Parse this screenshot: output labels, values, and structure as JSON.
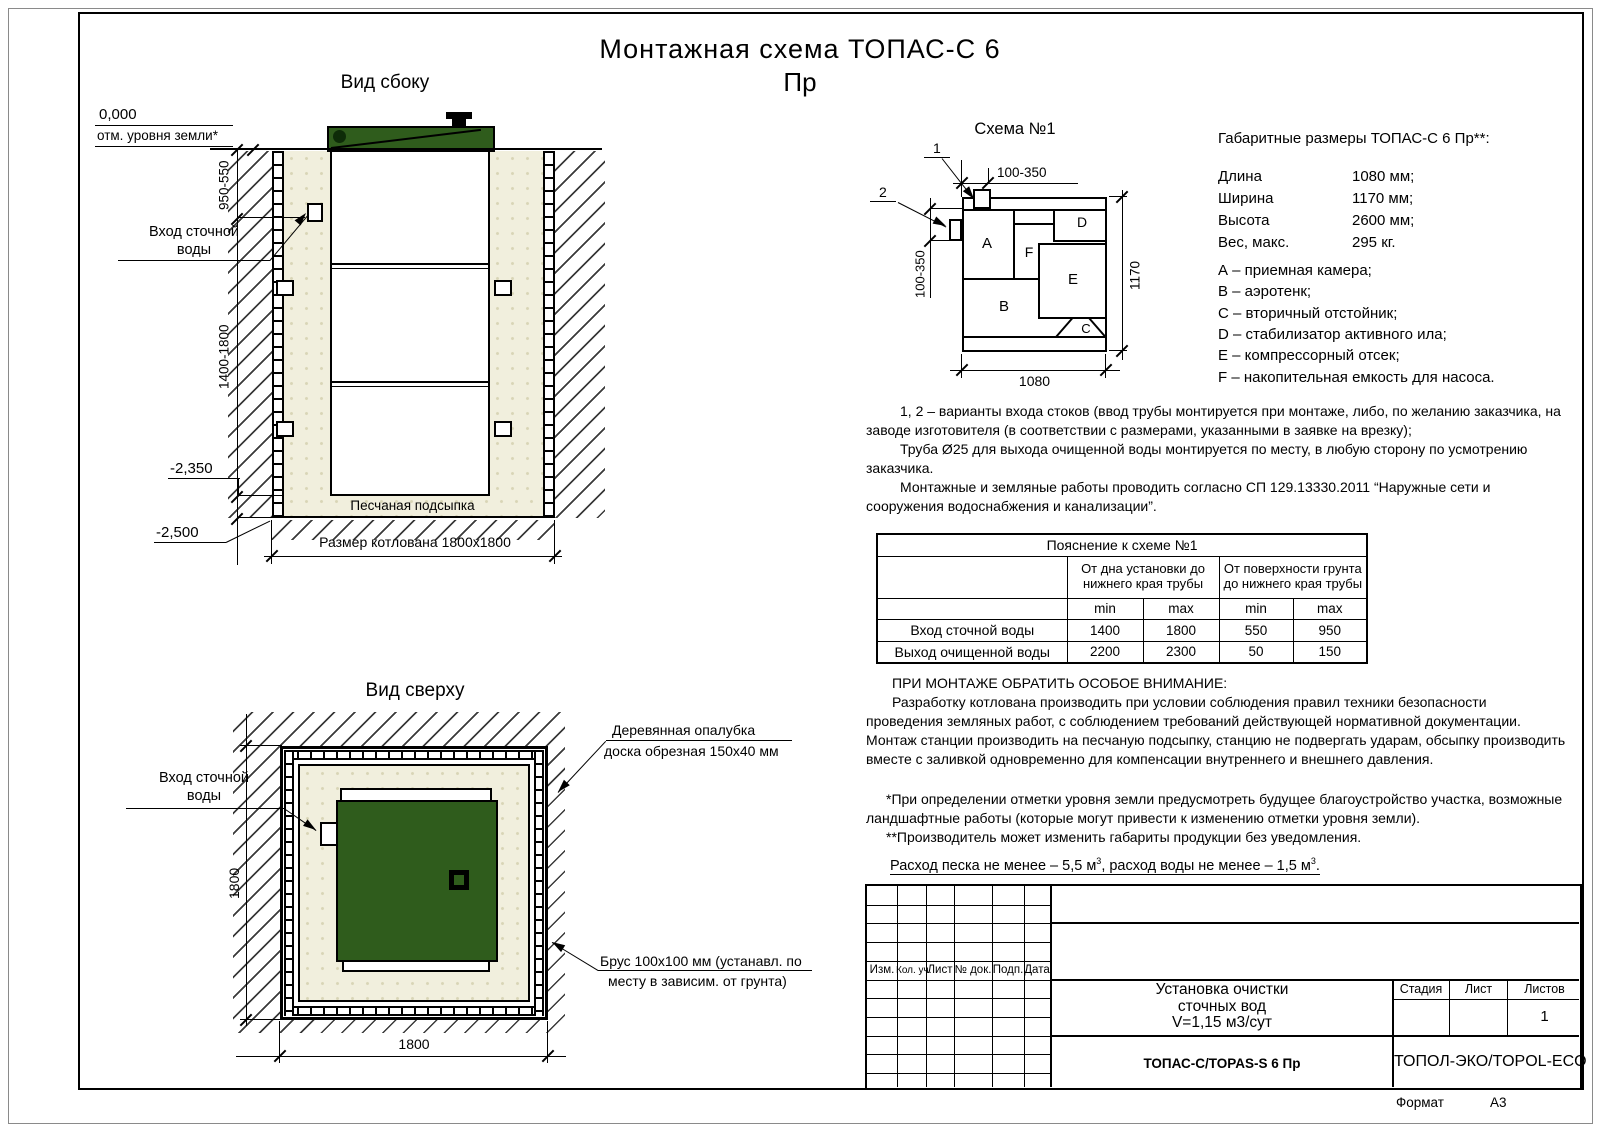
{
  "title": {
    "line1": "Монтажная схема ТОПАС-С 6",
    "line2": "Пр"
  },
  "colors": {
    "lid_green": "#2f5c1c",
    "sand": "#f1efdd"
  },
  "side_view": {
    "title": "Вид сбоку",
    "zero_mark": "0,000",
    "ground_label": "отм. уровня земли*",
    "dim_upper": "950-550",
    "dim_lower": "1400-1800",
    "inlet_line1": "Вход сточной",
    "inlet_line2": "воды",
    "elev_base": "-2,350",
    "elev_bottom": "-2,500",
    "sand_bed": "Песчаная подсыпка",
    "pit_size": "Размер котлована 1800x1800"
  },
  "top_view": {
    "title": "Вид сверху",
    "inlet_line1": "Вход сточной",
    "inlet_line2": "воды",
    "dim_vertical": "1800",
    "dim_horizontal": "1800",
    "callout_formwork_line1": "Деревянная опалубка",
    "callout_formwork_line2": "доска обрезная 150x40 мм",
    "callout_beam_line1": "Брус 100x100 мм (устанавл. по",
    "callout_beam_line2": "месту в зависим. от грунта)"
  },
  "schema": {
    "title": "Схема №1",
    "pointer1": "1",
    "pointer2": "2",
    "dim_top": "100-350",
    "dim_left": "100-350",
    "dim_bottom": "1080",
    "dim_right": "1170",
    "comp_a": "A",
    "comp_b": "B",
    "comp_c": "C",
    "comp_d": "D",
    "comp_e": "E",
    "comp_f": "F"
  },
  "dimensions": {
    "heading": "Габаритные размеры ТОПАС-С 6 Пр**:",
    "rows": [
      {
        "label": "Длина",
        "value": "1080 мм;"
      },
      {
        "label": "Ширина",
        "value": "1170 мм;"
      },
      {
        "label": "Высота",
        "value": "2600 мм;"
      },
      {
        "label": "Вес, макс.",
        "value": "295 кг."
      }
    ],
    "legend": [
      "А – приемная камера;",
      "В – аэротенк;",
      "С – вторичный отстойник;",
      "D – стабилизатор активного ила;",
      "E – компрессорный отсек;",
      "F – накопительная емкость для насоса."
    ]
  },
  "notes": {
    "variants_p1": "1, 2 – варианты входа  стоков (ввод трубы монтируется при монтаже, либо, по желанию заказчика, на заводе изготовителя (в соответствии с размерами, указанными в заявке на врезку);",
    "variants_p2": "Труба Ø25 для выхода очищенной воды монтируется по месту, в любую сторону по усмотрению заказчика.",
    "works": "Монтажные и земляные работы проводить согласно СП 129.13330.2011 “Наружные сети и сооружения водоснабжения и канализации”.",
    "attention_title": "ПРИ МОНТАЖЕ ОБРАТИТЬ ОСОБОЕ ВНИМАНИЕ:",
    "attention_body": "Разработку котлована производить при условии соблюдения правил техники безопасности проведения земляных работ, с соблюдением требований действующей нормативной документации. Монтаж станции производить на песчаную подсыпку, станцию не подвергать ударам, обсыпку производить вместе с заливкой одновременно для компенсации внутреннего и внешнего давления.",
    "footnote1": "*При определении отметки уровня земли предусмотреть будущее благоустройство участка, возможные ландшафтные работы (которые могут привести к изменению отметки уровня земли).",
    "footnote2": "**Производитель может изменить габариты продукции без уведомления.",
    "consumption_p1": "Расход песка не менее – 5,5 м",
    "consumption_sup1": "3",
    "consumption_p2": ", расход воды не менее – 1,5 м",
    "consumption_sup2": "3",
    "consumption_p3": "."
  },
  "explanation_table": {
    "title": "Пояснение к схеме №1",
    "col_group1": "От дна установки до нижнего края трубы",
    "col_group2": "От поверхности грунта до нижнего края трубы",
    "min_label": "min",
    "max_label": "max",
    "rows": [
      {
        "label": "Вход сточной воды",
        "values": [
          "1400",
          "1800",
          "550",
          "950"
        ]
      },
      {
        "label": "Выход очищенной воды",
        "values": [
          "2200",
          "2300",
          "50",
          "150"
        ]
      }
    ]
  },
  "title_block": {
    "rev_headers": [
      "Изм.",
      "Кол. уч.",
      "Лист",
      "№ док.",
      "Подп.",
      "Дата"
    ],
    "doc_name_line1": "Установка очистки",
    "doc_name_line2": "сточных вод",
    "doc_name_line3": "V=1,15 м3/сут",
    "stage_label": "Стадия",
    "sheet_label": "Лист",
    "sheets_label": "Листов",
    "sheets_value": "1",
    "model": "ТОПАС-С/TOPAS-S 6 Пр",
    "company": "ТОПОЛ-ЭКО/TOPOL-ECO",
    "format_label": "Формат",
    "format_value": "А3"
  }
}
